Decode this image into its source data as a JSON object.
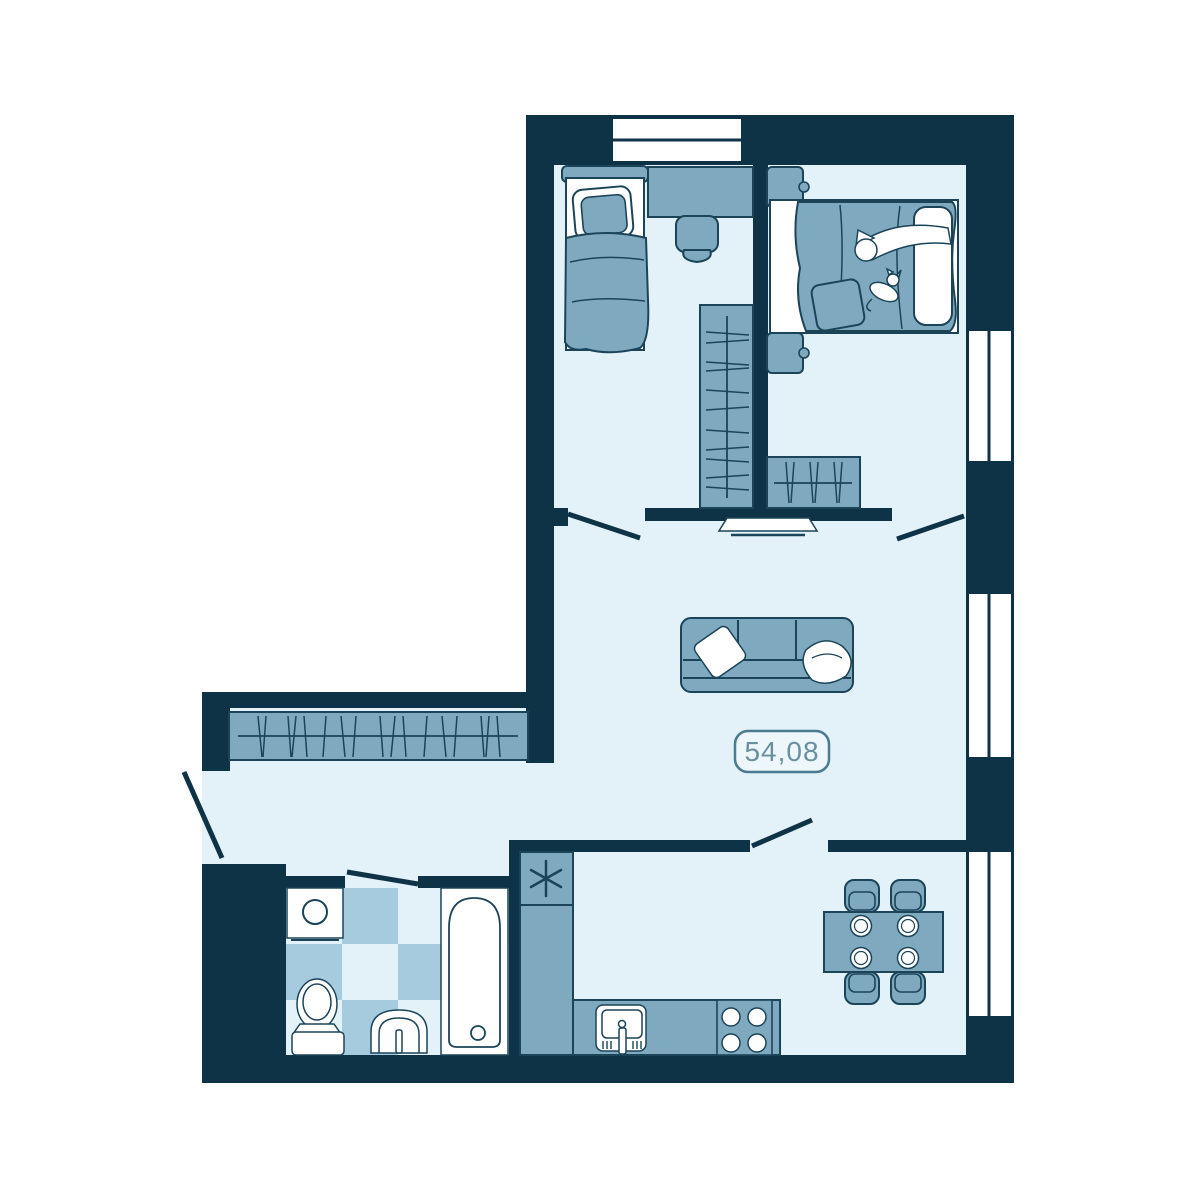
{
  "area_label": {
    "value": "54,08"
  },
  "colors": {
    "wall": "#0e3347",
    "floor": "#e3f1f8",
    "furniture": "#7ea9bf",
    "outline": "#1b4459",
    "tile": "#a6cbde",
    "label_border": "#4b7b90",
    "label_text": "#68909f",
    "white": "#ffffff"
  },
  "icons": {
    "fridge_symbol": "six-spoke asterisk (snowflake)",
    "window": "white inset with mullion",
    "door": "angled swing line",
    "hanger_rod": "rod line with hanger strokes"
  }
}
